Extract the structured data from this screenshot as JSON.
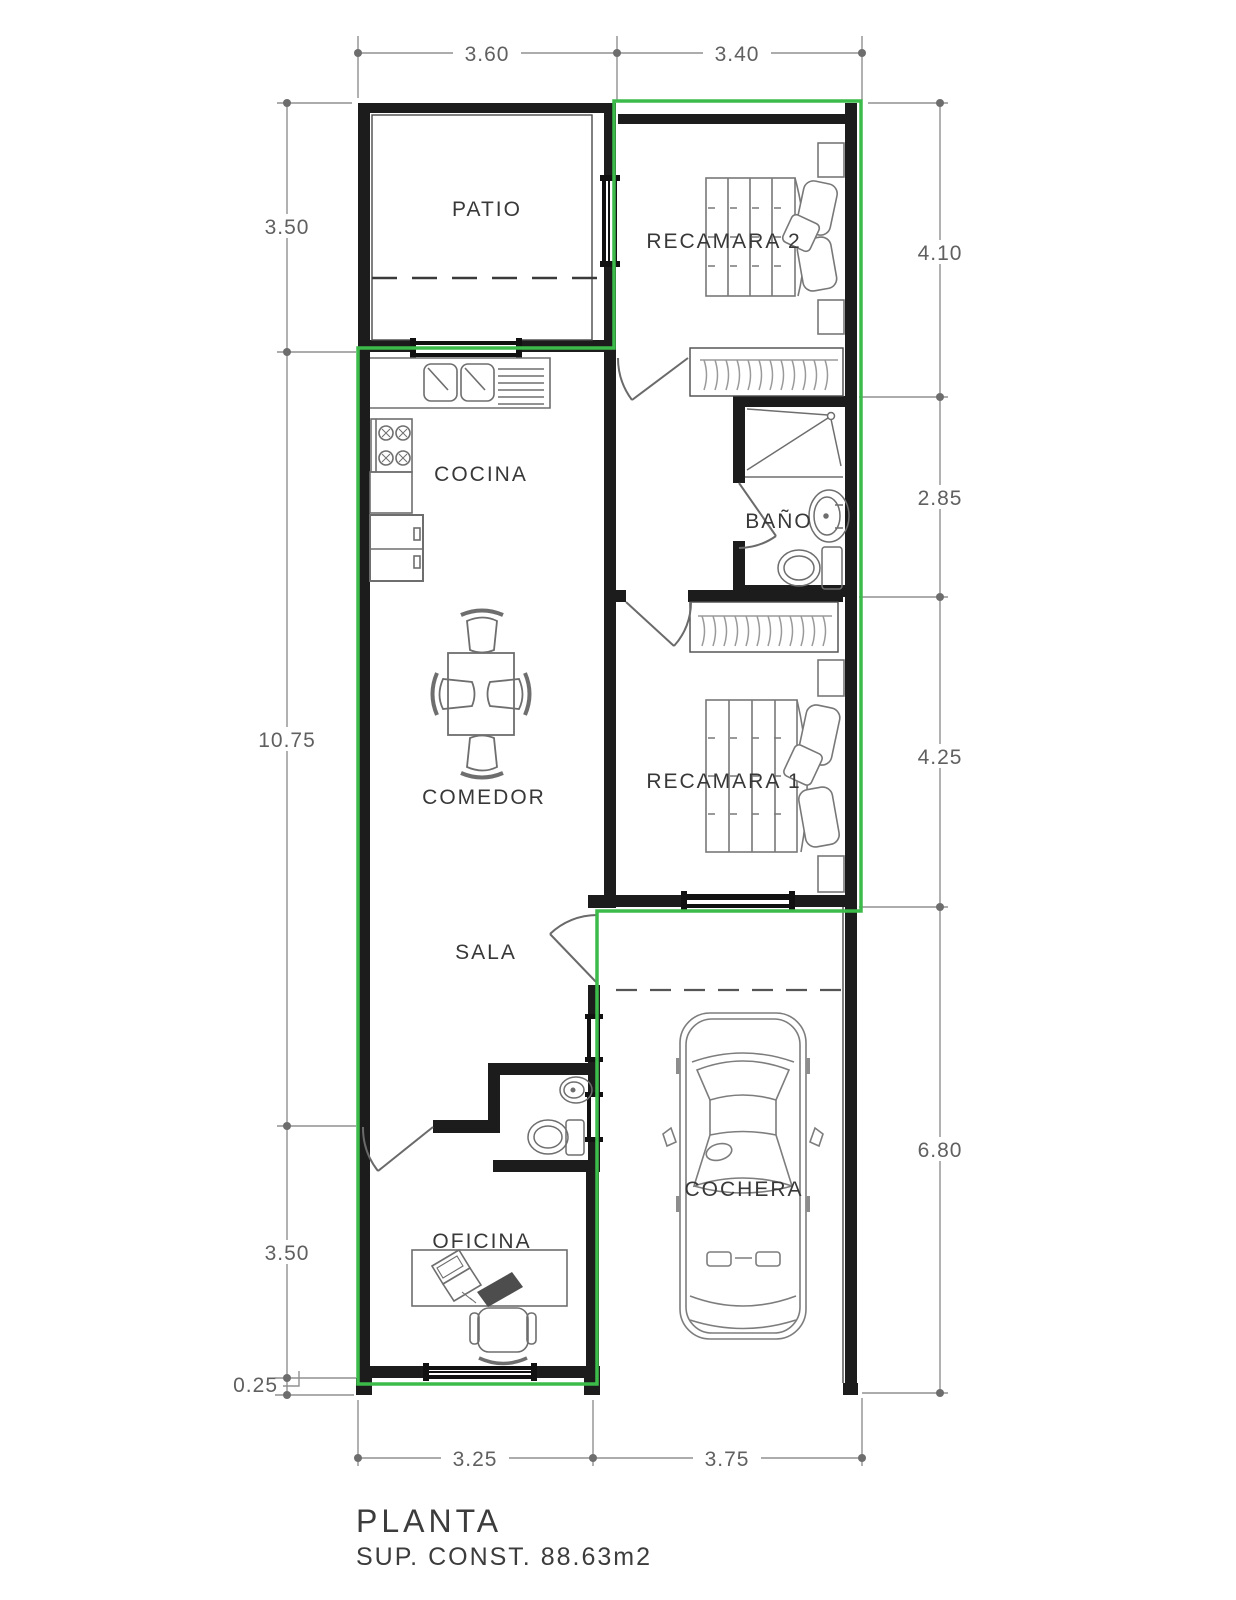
{
  "plan": {
    "title": "PLANTA",
    "subtitle": "SUP. CONST. 88.63m2",
    "rooms": {
      "patio": "PATIO",
      "recamara2": "RECAMARA 2",
      "cocina": "COCINA",
      "bano": "BAÑO",
      "comedor": "COMEDOR",
      "recamara1": "RECAMARA 1",
      "sala": "SALA",
      "cochera": "COCHERA",
      "oficina": "OFICINA"
    },
    "dimensions": {
      "top": [
        "3.60",
        "3.40"
      ],
      "left": [
        "3.50",
        "10.75",
        "3.50",
        "0.25"
      ],
      "right": [
        "4.10",
        "2.85",
        "4.25",
        "6.80"
      ],
      "bottom": [
        "3.25",
        "3.75"
      ]
    },
    "colors": {
      "boundary_green": "#3dbb4a",
      "wall_black": "#1c1c1c",
      "dimension_gray": "#8f8f8f"
    }
  }
}
